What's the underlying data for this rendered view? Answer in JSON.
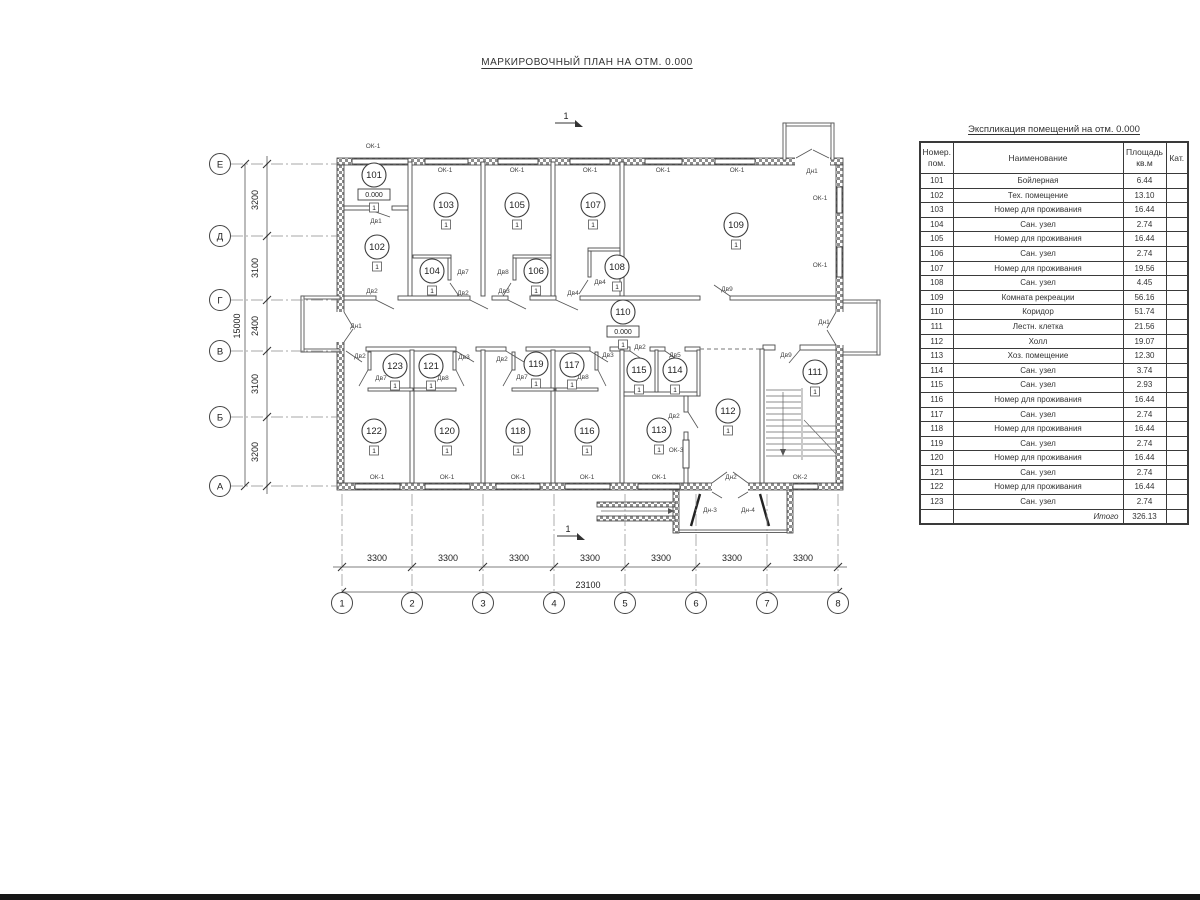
{
  "title": "МАРКИРОВОЧНЫЙ ПЛАН НА ОТМ. 0.000",
  "table": {
    "title": "Экспликация помещений на отм. 0.000",
    "headers": [
      "Номер.\nпом.",
      "Наименование",
      "Площадь\nкв.м",
      "Кат."
    ],
    "rows": [
      {
        "num": "101",
        "name": "Бойлерная",
        "area": "6.44",
        "cat": ""
      },
      {
        "num": "102",
        "name": "Тех. помещение",
        "area": "13.10",
        "cat": ""
      },
      {
        "num": "103",
        "name": "Номер для проживания",
        "area": "16.44",
        "cat": ""
      },
      {
        "num": "104",
        "name": "Сан. узел",
        "area": "2.74",
        "cat": ""
      },
      {
        "num": "105",
        "name": "Номер для проживания",
        "area": "16.44",
        "cat": ""
      },
      {
        "num": "106",
        "name": "Сан. узел",
        "area": "2.74",
        "cat": ""
      },
      {
        "num": "107",
        "name": "Номер для проживания",
        "area": "19.56",
        "cat": ""
      },
      {
        "num": "108",
        "name": "Сан. узел",
        "area": "4.45",
        "cat": ""
      },
      {
        "num": "109",
        "name": "Комната рекреации",
        "area": "56.16",
        "cat": ""
      },
      {
        "num": "110",
        "name": "Коридор",
        "area": "51.74",
        "cat": ""
      },
      {
        "num": "111",
        "name": "Лестн. клетка",
        "area": "21.56",
        "cat": ""
      },
      {
        "num": "112",
        "name": "Холл",
        "area": "19.07",
        "cat": ""
      },
      {
        "num": "113",
        "name": "Хоз. помещение",
        "area": "12.30",
        "cat": ""
      },
      {
        "num": "114",
        "name": "Сан. узел",
        "area": "3.74",
        "cat": ""
      },
      {
        "num": "115",
        "name": "Сан. узел",
        "area": "2.93",
        "cat": ""
      },
      {
        "num": "116",
        "name": "Номер для проживания",
        "area": "16.44",
        "cat": ""
      },
      {
        "num": "117",
        "name": "Сан. узел",
        "area": "2.74",
        "cat": ""
      },
      {
        "num": "118",
        "name": "Номер для проживания",
        "area": "16.44",
        "cat": ""
      },
      {
        "num": "119",
        "name": "Сан. узел",
        "area": "2.74",
        "cat": ""
      },
      {
        "num": "120",
        "name": "Номер для проживания",
        "area": "16.44",
        "cat": ""
      },
      {
        "num": "121",
        "name": "Сан. узел",
        "area": "2.74",
        "cat": ""
      },
      {
        "num": "122",
        "name": "Номер для проживания",
        "area": "16.44",
        "cat": ""
      },
      {
        "num": "123",
        "name": "Сан. узел",
        "area": "2.74",
        "cat": ""
      }
    ],
    "total_label": "Итого",
    "total_value": "326.13"
  },
  "plan": {
    "level_mark": "0.000",
    "floor_marker": "1",
    "section_mark": "1",
    "section_positions": [
      {
        "x": 566,
        "y": 119
      },
      {
        "x": 568,
        "y": 532
      }
    ],
    "rooms": [
      {
        "n": "101",
        "x": 374,
        "y": 175,
        "lvl": true
      },
      {
        "n": "102",
        "x": 377,
        "y": 247
      },
      {
        "n": "103",
        "x": 446,
        "y": 205
      },
      {
        "n": "104",
        "x": 432,
        "y": 271
      },
      {
        "n": "105",
        "x": 517,
        "y": 205
      },
      {
        "n": "106",
        "x": 536,
        "y": 271
      },
      {
        "n": "107",
        "x": 593,
        "y": 205
      },
      {
        "n": "108",
        "x": 617,
        "y": 267
      },
      {
        "n": "109",
        "x": 736,
        "y": 225
      },
      {
        "n": "110",
        "x": 623,
        "y": 312,
        "lvl": true
      },
      {
        "n": "111",
        "x": 815,
        "y": 372
      },
      {
        "n": "112",
        "x": 728,
        "y": 411
      },
      {
        "n": "113",
        "x": 659,
        "y": 430
      },
      {
        "n": "114",
        "x": 675,
        "y": 370
      },
      {
        "n": "115",
        "x": 639,
        "y": 370
      },
      {
        "n": "116",
        "x": 587,
        "y": 431
      },
      {
        "n": "117",
        "x": 572,
        "y": 365
      },
      {
        "n": "118",
        "x": 518,
        "y": 431
      },
      {
        "n": "119",
        "x": 536,
        "y": 364
      },
      {
        "n": "120",
        "x": 447,
        "y": 431
      },
      {
        "n": "121",
        "x": 431,
        "y": 366
      },
      {
        "n": "122",
        "x": 374,
        "y": 431
      },
      {
        "n": "123",
        "x": 395,
        "y": 366
      }
    ],
    "labels": [
      {
        "t": "ОК-1",
        "x": 373,
        "y": 148
      },
      {
        "t": "ОК-1",
        "x": 445,
        "y": 172
      },
      {
        "t": "ОК-1",
        "x": 517,
        "y": 172
      },
      {
        "t": "ОК-1",
        "x": 590,
        "y": 172
      },
      {
        "t": "ОК-1",
        "x": 663,
        "y": 172
      },
      {
        "t": "ОК-1",
        "x": 737,
        "y": 172
      },
      {
        "t": "ОК-1",
        "x": 820,
        "y": 200
      },
      {
        "t": "ОК-1",
        "x": 820,
        "y": 267
      },
      {
        "t": "ОК-1",
        "x": 377,
        "y": 479
      },
      {
        "t": "ОК-1",
        "x": 447,
        "y": 479
      },
      {
        "t": "ОК-1",
        "x": 518,
        "y": 479
      },
      {
        "t": "ОК-1",
        "x": 587,
        "y": 479
      },
      {
        "t": "ОК-1",
        "x": 659,
        "y": 479
      },
      {
        "t": "ОК-2",
        "x": 800,
        "y": 479
      },
      {
        "t": "ОК-3",
        "x": 676,
        "y": 452
      },
      {
        "t": "Дн1",
        "x": 812,
        "y": 173
      },
      {
        "t": "Дн1",
        "x": 356,
        "y": 328
      },
      {
        "t": "Дн1",
        "x": 824,
        "y": 324
      },
      {
        "t": "Дн2",
        "x": 731,
        "y": 479
      },
      {
        "t": "Дн-3",
        "x": 710,
        "y": 512
      },
      {
        "t": "Дн-4",
        "x": 748,
        "y": 512
      },
      {
        "t": "Дв1",
        "x": 376,
        "y": 223
      },
      {
        "t": "Дв2",
        "x": 372,
        "y": 293
      },
      {
        "t": "Дв7",
        "x": 463,
        "y": 274
      },
      {
        "t": "Дв2",
        "x": 463,
        "y": 295
      },
      {
        "t": "Дв8",
        "x": 503,
        "y": 274
      },
      {
        "t": "Дв3",
        "x": 504,
        "y": 293
      },
      {
        "t": "Дв4",
        "x": 573,
        "y": 295
      },
      {
        "t": "Дв4",
        "x": 600,
        "y": 284
      },
      {
        "t": "Дв9",
        "x": 727,
        "y": 291
      },
      {
        "t": "Дв2",
        "x": 360,
        "y": 358
      },
      {
        "t": "Дв3",
        "x": 464,
        "y": 359
      },
      {
        "t": "Дв2",
        "x": 502,
        "y": 361
      },
      {
        "t": "Дв3",
        "x": 608,
        "y": 357
      },
      {
        "t": "Дв2",
        "x": 640,
        "y": 349
      },
      {
        "t": "Дв5",
        "x": 675,
        "y": 357
      },
      {
        "t": "Дв9",
        "x": 786,
        "y": 357
      },
      {
        "t": "Дв7",
        "x": 381,
        "y": 380
      },
      {
        "t": "Дв8",
        "x": 443,
        "y": 380
      },
      {
        "t": "Дв7",
        "x": 522,
        "y": 379
      },
      {
        "t": "Дв8",
        "x": 583,
        "y": 379
      },
      {
        "t": "Дв2",
        "x": 674,
        "y": 418
      }
    ],
    "axes_bottom": [
      {
        "t": "1",
        "x": 342
      },
      {
        "t": "2",
        "x": 412
      },
      {
        "t": "3",
        "x": 483
      },
      {
        "t": "4",
        "x": 554
      },
      {
        "t": "5",
        "x": 625
      },
      {
        "t": "6",
        "x": 696
      },
      {
        "t": "7",
        "x": 767
      },
      {
        "t": "8",
        "x": 838
      }
    ],
    "axes_left": [
      {
        "t": "Е",
        "y": 164
      },
      {
        "t": "Д",
        "y": 236
      },
      {
        "t": "Г",
        "y": 300
      },
      {
        "t": "В",
        "y": 351
      },
      {
        "t": "Б",
        "y": 417
      },
      {
        "t": "А",
        "y": 486
      }
    ],
    "dims_bottom": [
      {
        "t": "3300",
        "x": 377
      },
      {
        "t": "3300",
        "x": 448
      },
      {
        "t": "3300",
        "x": 519
      },
      {
        "t": "3300",
        "x": 590
      },
      {
        "t": "3300",
        "x": 661
      },
      {
        "t": "3300",
        "x": 732
      },
      {
        "t": "3300",
        "x": 803
      }
    ],
    "dim_total_bottom": "23100",
    "dims_left": [
      {
        "t": "3200",
        "y": 200
      },
      {
        "t": "3100",
        "y": 268
      },
      {
        "t": "2400",
        "y": 326
      },
      {
        "t": "3100",
        "y": 384
      },
      {
        "t": "3200",
        "y": 452
      }
    ],
    "dim_total_left": "15000"
  }
}
